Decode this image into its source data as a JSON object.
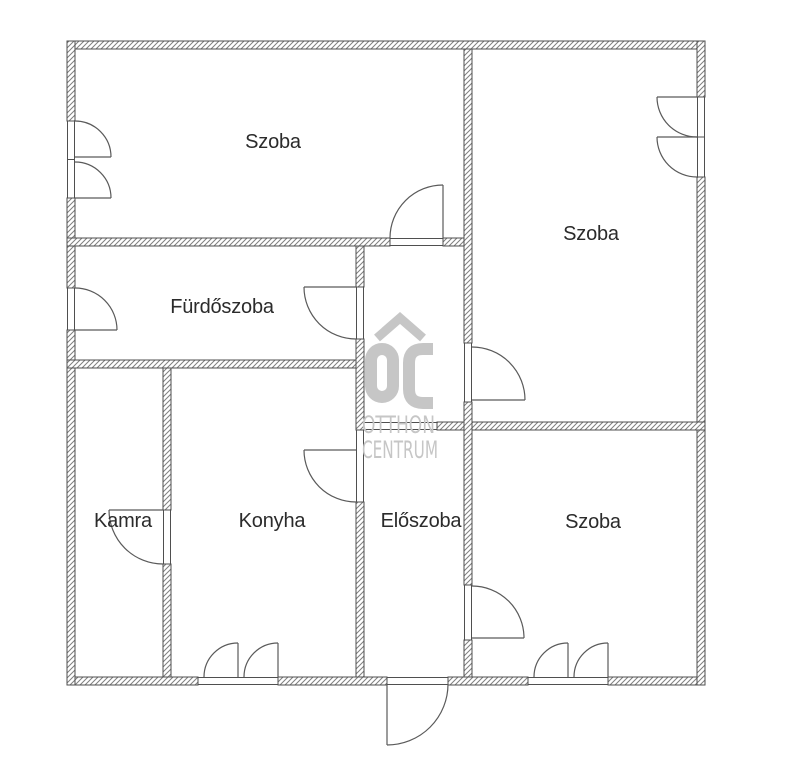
{
  "floorplan": {
    "title": "apartment-floor-plan",
    "rooms": [
      {
        "name": "szoba-top-left",
        "label": "Szoba"
      },
      {
        "name": "szoba-top-right",
        "label": "Szoba"
      },
      {
        "name": "furdoszoba",
        "label": "Fürdőszoba"
      },
      {
        "name": "kamra",
        "label": "Kamra"
      },
      {
        "name": "konyha",
        "label": "Konyha"
      },
      {
        "name": "eloszoba",
        "label": "Előszoba"
      },
      {
        "name": "szoba-bottom-right",
        "label": "Szoba"
      }
    ],
    "watermark": {
      "logo": "OC",
      "line1": "OTTHON",
      "line2": "CENTRUM",
      "color": "#c6c6c6"
    },
    "colors": {
      "background": "#ffffff",
      "wall_outline": "#4f4f4f",
      "wall_hatch": "#7f7f7f",
      "door_line": "#5a5a5a",
      "label_text": "#2b2b2b"
    }
  }
}
